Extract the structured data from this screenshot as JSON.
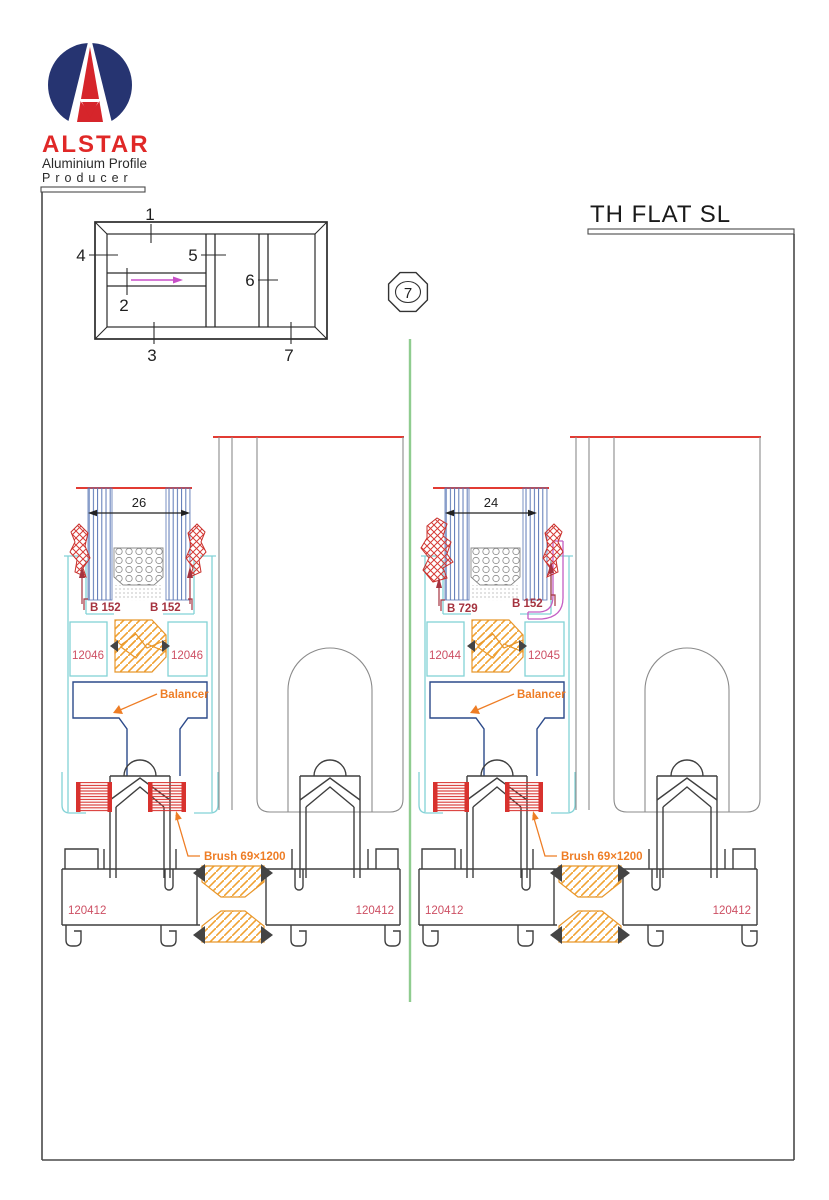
{
  "page": {
    "title": "TH FLAT SL"
  },
  "logo": {
    "brand": "ALSTAR",
    "line1": "Aluminium Profile",
    "line2": "Producer"
  },
  "schematic": {
    "n1": "1",
    "n2": "2",
    "n3": "3",
    "n4": "4",
    "n5": "5",
    "n6": "6",
    "n7": "7"
  },
  "marker": {
    "number": "7"
  },
  "left": {
    "dim": "26",
    "gasket_left": "B 152",
    "gasket_right": "B 152",
    "chamber_left": "12046",
    "chamber_right": "12046",
    "balancer": "Balancer",
    "brush": "Brush 69×1200",
    "sill_left": "120412",
    "sill_right": "120412"
  },
  "right": {
    "dim": "24",
    "gasket_left": "B 729",
    "gasket_right": "B 152",
    "chamber_left": "12044",
    "chamber_right": "12045",
    "balancer": "Balancer",
    "brush": "Brush 69×1200",
    "sill_left": "120412",
    "sill_right": "120412"
  },
  "colors": {
    "accent_red": "#d6252b",
    "logo_blue": "#263471",
    "cyan_profile": "#82d2d6",
    "orange_label": "#ee7d25",
    "orange_hatch": "#f0a232",
    "crimson_label": "#cd4f63",
    "dark_red_label": "#a5333f",
    "magenta_bead": "#c45ec4",
    "glass_blue": "#5a77b5",
    "balancer_blue": "#2c4a8a",
    "green_centerline": "#8fcc8f",
    "profile_gray": "#8b8b8b",
    "outline_dark": "#3f3f3f"
  }
}
